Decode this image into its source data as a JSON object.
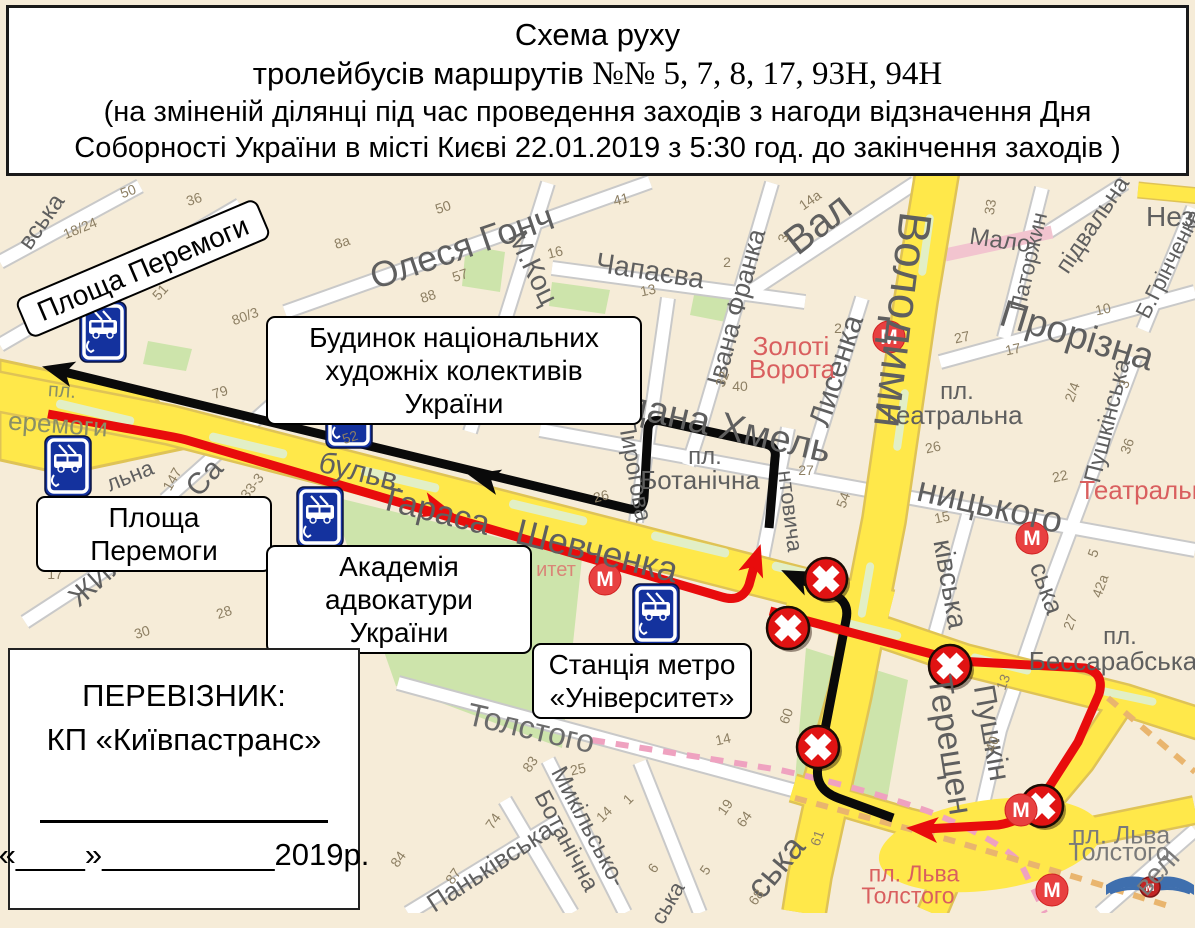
{
  "title": {
    "line1": "Схема руху",
    "line2_sans": "тролейбусів маршрутів ",
    "line2_serif": "№№ 5, 7, 8, 17, 93Н, 94Н",
    "line3": "(на зміненій ділянці під час проведення заходів з нагоди відзначення  Дня",
    "line4": "Соборності України в місті Києві 22.01.2019 з 5:30 год. до закінчення заходів )"
  },
  "carrier": {
    "label": "ПЕРЕВІЗНИК:",
    "name": "КП «Київпастранс»",
    "date_line": "«____»__________2019р."
  },
  "callouts": {
    "peremohy_rotated": "Площа Перемоги",
    "budynok_l1": "Будинок національних",
    "budynok_l2": "художніх колективів України",
    "peremohy": "Площа Перемоги",
    "akademia_l1": "Академія",
    "akademia_l2": "адвокатури України",
    "metro_l1": "Станція метро",
    "metro_l2": "«Університет»"
  },
  "colors": {
    "route_black": "#0a0a0a",
    "route_red": "#e80c0c",
    "road_yellow": "#ffe84a",
    "road_casing": "#dfc356",
    "park_green": "#cde4ab",
    "median_green": "#e2efc6",
    "closed_sign_red": "#e01313",
    "stop_sign_blue": "#14329e",
    "metro_red": "#e84040",
    "pink_street": "#f2c4cf",
    "metro_line_pink": "#efa2c0",
    "metro_line_tan": "#e9b56e"
  },
  "map": {
    "street_labels": [
      {
        "t": "вська",
        "x": 42,
        "y": 222,
        "r": -55,
        "s": 24
      },
      {
        "t": "льна",
        "x": 130,
        "y": 476,
        "r": -22,
        "s": 22
      },
      {
        "t": "Са",
        "x": 205,
        "y": 478,
        "r": -48,
        "s": 30
      },
      {
        "t": "ЖИЛЯН",
        "x": 112,
        "y": 566,
        "r": -42,
        "s": 28
      },
      {
        "t": "пл.",
        "x": 62,
        "y": 391,
        "r": 4,
        "s": 20,
        "c": "#8a8f66"
      },
      {
        "t": "еремоги",
        "x": 58,
        "y": 424,
        "r": 4,
        "s": 26,
        "c": "#8a8f66"
      },
      {
        "t": "бульв.",
        "x": 362,
        "y": 473,
        "r": 14,
        "s": 30
      },
      {
        "t": "Тараса",
        "x": 435,
        "y": 511,
        "r": 14,
        "s": 34
      },
      {
        "t": "Шевченка",
        "x": 597,
        "y": 551,
        "r": 14,
        "s": 36
      },
      {
        "t": "Олеся Гонч",
        "x": 462,
        "y": 247,
        "r": -19,
        "s": 36
      },
      {
        "t": "М.Коц",
        "x": 533,
        "y": 268,
        "r": 64,
        "s": 28
      },
      {
        "t": "Чапаєва",
        "x": 650,
        "y": 271,
        "r": 9,
        "s": 28
      },
      {
        "t": "Івана Франка",
        "x": 736,
        "y": 307,
        "r": -75,
        "s": 26
      },
      {
        "t": "Вал",
        "x": 818,
        "y": 224,
        "r": -38,
        "s": 40
      },
      {
        "t": "Лисенка",
        "x": 837,
        "y": 371,
        "r": -72,
        "s": 30
      },
      {
        "t": "Золоті",
        "x": 791,
        "y": 346,
        "r": 0,
        "s": 26,
        "c": "#d95f5f"
      },
      {
        "t": "Ворота",
        "x": 792,
        "y": 369,
        "r": 0,
        "s": 26,
        "c": "#d95f5f"
      },
      {
        "t": "Володими",
        "x": 903,
        "y": 320,
        "r": 97,
        "s": 46
      },
      {
        "t": "Богдана Хмель",
        "x": 700,
        "y": 421,
        "r": 13,
        "s": 38
      },
      {
        "t": "ницького",
        "x": 990,
        "y": 505,
        "r": 13,
        "s": 36
      },
      {
        "t": "пл.",
        "x": 705,
        "y": 457,
        "r": 0,
        "s": 24
      },
      {
        "t": "Ботанічна",
        "x": 700,
        "y": 480,
        "r": 0,
        "s": 26
      },
      {
        "t": "Пирогова",
        "x": 634,
        "y": 470,
        "r": 80,
        "s": 24
      },
      {
        "t": "нтовича",
        "x": 790,
        "y": 511,
        "r": 83,
        "s": 22
      },
      {
        "t": "пл.",
        "x": 957,
        "y": 392,
        "r": 0,
        "s": 24
      },
      {
        "t": "Театральна",
        "x": 952,
        "y": 415,
        "r": 0,
        "s": 26
      },
      {
        "t": "Прорізна",
        "x": 1077,
        "y": 336,
        "r": 17,
        "s": 38
      },
      {
        "t": "Мало",
        "x": 1000,
        "y": 241,
        "r": 8,
        "s": 24
      },
      {
        "t": "підвальна",
        "x": 1093,
        "y": 225,
        "r": -56,
        "s": 24
      },
      {
        "t": "Паторжин",
        "x": 1029,
        "y": 262,
        "r": -77,
        "s": 22
      },
      {
        "t": "Б.Грінченка",
        "x": 1169,
        "y": 264,
        "r": -63,
        "s": 22
      },
      {
        "t": "Нез",
        "x": 1170,
        "y": 217,
        "r": 0,
        "s": 28
      },
      {
        "t": "Театральна",
        "x": 1150,
        "y": 490,
        "r": 0,
        "s": 26,
        "c": "#d95f5f"
      },
      {
        "t": "ківська",
        "x": 950,
        "y": 584,
        "r": 80,
        "s": 28
      },
      {
        "t": "ська",
        "x": 1047,
        "y": 588,
        "r": 70,
        "s": 26
      },
      {
        "t": "Пушкінська",
        "x": 1108,
        "y": 421,
        "r": -76,
        "s": 24
      },
      {
        "t": "Пушкін",
        "x": 991,
        "y": 733,
        "r": 80,
        "s": 30
      },
      {
        "t": "Терещен",
        "x": 950,
        "y": 745,
        "r": 81,
        "s": 34
      },
      {
        "t": "пл.",
        "x": 1120,
        "y": 637,
        "r": 0,
        "s": 24
      },
      {
        "t": "Бессарабська",
        "x": 1113,
        "y": 661,
        "r": 0,
        "s": 26
      },
      {
        "t": "Толстого",
        "x": 531,
        "y": 728,
        "r": 13,
        "s": 32,
        "c": "#6b6b6b"
      },
      {
        "t": "Микільсько-",
        "x": 588,
        "y": 827,
        "r": 62,
        "s": 24
      },
      {
        "t": "Ботанічна",
        "x": 566,
        "y": 841,
        "r": 62,
        "s": 24
      },
      {
        "t": "Паньківська",
        "x": 490,
        "y": 866,
        "r": -33,
        "s": 26
      },
      {
        "t": "ська",
        "x": 776,
        "y": 867,
        "r": -50,
        "s": 34
      },
      {
        "t": "ська",
        "x": 668,
        "y": 903,
        "r": -60,
        "s": 22
      },
      {
        "t": "пл. Льва",
        "x": 914,
        "y": 874,
        "r": 0,
        "s": 23,
        "c": "#d95f5f"
      },
      {
        "t": "Толстого",
        "x": 908,
        "y": 896,
        "r": 0,
        "s": 23,
        "c": "#d95f5f"
      },
      {
        "t": "пл. Льва",
        "x": 1121,
        "y": 836,
        "r": 0,
        "s": 25,
        "c": "#7a7a7a"
      },
      {
        "t": "Толстого",
        "x": 1119,
        "y": 853,
        "r": 0,
        "s": 25,
        "c": "#7a7a7a"
      },
      {
        "t": "велі",
        "x": 1157,
        "y": 872,
        "r": -48,
        "s": 28,
        "c": "#7a7a7a"
      },
      {
        "t": "итет",
        "x": 556,
        "y": 570,
        "r": 0,
        "s": 20,
        "c": "#d98577"
      },
      {
        "t": "ров.",
        "x": 382,
        "y": 404,
        "r": 0,
        "s": 15
      }
    ],
    "house_numbers": [
      {
        "t": "18/24",
        "x": 80,
        "y": 228,
        "r": -22
      },
      {
        "t": "50",
        "x": 128,
        "y": 191,
        "r": -20
      },
      {
        "t": "36",
        "x": 194,
        "y": 199,
        "r": -18
      },
      {
        "t": "39",
        "x": 252,
        "y": 217,
        "r": -18
      },
      {
        "t": "51",
        "x": 160,
        "y": 292,
        "r": -48
      },
      {
        "t": "80/3",
        "x": 245,
        "y": 316,
        "r": -20
      },
      {
        "t": "8а",
        "x": 342,
        "y": 242,
        "r": -18
      },
      {
        "t": "50",
        "x": 443,
        "y": 207,
        "r": -18
      },
      {
        "t": "88",
        "x": 428,
        "y": 296,
        "r": -18
      },
      {
        "t": "57",
        "x": 460,
        "y": 275,
        "r": -18
      },
      {
        "t": "16",
        "x": 555,
        "y": 252,
        "r": -14
      },
      {
        "t": "41",
        "x": 621,
        "y": 199,
        "r": -14
      },
      {
        "t": "13",
        "x": 648,
        "y": 290,
        "r": -12
      },
      {
        "t": "79",
        "x": 220,
        "y": 392,
        "r": -18
      },
      {
        "t": "52",
        "x": 350,
        "y": 437,
        "r": -18
      },
      {
        "t": "33-3",
        "x": 252,
        "y": 486,
        "r": -52
      },
      {
        "t": "147",
        "x": 172,
        "y": 479,
        "r": -60
      },
      {
        "t": "17",
        "x": 55,
        "y": 574,
        "r": 0
      },
      {
        "t": "28",
        "x": 224,
        "y": 612,
        "r": -18
      },
      {
        "t": "30",
        "x": 142,
        "y": 632,
        "r": -18
      },
      {
        "t": "106",
        "x": 337,
        "y": 617,
        "r": -70
      },
      {
        "t": "37",
        "x": 568,
        "y": 407,
        "r": -14
      },
      {
        "t": "26",
        "x": 601,
        "y": 496,
        "r": -14
      },
      {
        "t": "40",
        "x": 740,
        "y": 386,
        "r": 0
      },
      {
        "t": "32",
        "x": 722,
        "y": 379,
        "r": -70
      },
      {
        "t": "27",
        "x": 806,
        "y": 470,
        "r": 0
      },
      {
        "t": "2",
        "x": 838,
        "y": 328,
        "r": 0
      },
      {
        "t": "14а",
        "x": 810,
        "y": 200,
        "r": -35
      },
      {
        "t": "3",
        "x": 783,
        "y": 238,
        "r": -70
      },
      {
        "t": "2",
        "x": 727,
        "y": 262,
        "r": 0
      },
      {
        "t": "33",
        "x": 990,
        "y": 207,
        "r": -80
      },
      {
        "t": "27",
        "x": 962,
        "y": 337,
        "r": -12
      },
      {
        "t": "17",
        "x": 1013,
        "y": 349,
        "r": -12
      },
      {
        "t": "10",
        "x": 1103,
        "y": 309,
        "r": -12
      },
      {
        "t": "2/4",
        "x": 1072,
        "y": 392,
        "r": -70
      },
      {
        "t": "3",
        "x": 1124,
        "y": 384,
        "r": -70
      },
      {
        "t": "36",
        "x": 1127,
        "y": 446,
        "r": -70
      },
      {
        "t": "26",
        "x": 933,
        "y": 447,
        "r": -12
      },
      {
        "t": "22",
        "x": 1060,
        "y": 476,
        "r": -12
      },
      {
        "t": "15",
        "x": 942,
        "y": 517,
        "r": -12
      },
      {
        "t": "54",
        "x": 843,
        "y": 500,
        "r": -70
      },
      {
        "t": "5",
        "x": 1093,
        "y": 553,
        "r": -70
      },
      {
        "t": "42а",
        "x": 1100,
        "y": 586,
        "r": -70
      },
      {
        "t": "27",
        "x": 1070,
        "y": 622,
        "r": -70
      },
      {
        "t": "13",
        "x": 1003,
        "y": 682,
        "r": -70
      },
      {
        "t": "40",
        "x": 992,
        "y": 744,
        "r": -70
      },
      {
        "t": "60",
        "x": 786,
        "y": 716,
        "r": -70
      },
      {
        "t": "14",
        "x": 723,
        "y": 739,
        "r": -12
      },
      {
        "t": "61",
        "x": 817,
        "y": 838,
        "r": -70
      },
      {
        "t": "19",
        "x": 725,
        "y": 807,
        "r": -55
      },
      {
        "t": "64",
        "x": 744,
        "y": 819,
        "r": -55
      },
      {
        "t": "68",
        "x": 756,
        "y": 897,
        "r": -55
      },
      {
        "t": "5",
        "x": 705,
        "y": 870,
        "r": -55
      },
      {
        "t": "6",
        "x": 653,
        "y": 868,
        "r": -55
      },
      {
        "t": "25",
        "x": 578,
        "y": 769,
        "r": -12
      },
      {
        "t": "83",
        "x": 530,
        "y": 764,
        "r": -55
      },
      {
        "t": "74",
        "x": 493,
        "y": 821,
        "r": -55
      },
      {
        "t": "84",
        "x": 398,
        "y": 859,
        "r": -55
      },
      {
        "t": "87",
        "x": 453,
        "y": 876,
        "r": -55
      },
      {
        "t": "14",
        "x": 604,
        "y": 814,
        "r": -45
      },
      {
        "t": "1",
        "x": 628,
        "y": 799,
        "r": -45
      }
    ],
    "closed_signs": [
      {
        "x": 826,
        "y": 579
      },
      {
        "x": 788,
        "y": 628
      },
      {
        "x": 950,
        "y": 666
      },
      {
        "x": 818,
        "y": 747
      },
      {
        "x": 1042,
        "y": 806
      }
    ],
    "trolleybus_stops": [
      {
        "x": 103,
        "y": 332
      },
      {
        "x": 68,
        "y": 466
      },
      {
        "x": 349,
        "y": 418
      },
      {
        "x": 320,
        "y": 517
      },
      {
        "x": 656,
        "y": 614
      }
    ],
    "metro_stations": [
      {
        "x": 605,
        "y": 579
      },
      {
        "x": 889,
        "y": 337
      },
      {
        "x": 1032,
        "y": 538
      },
      {
        "x": 1021,
        "y": 810
      },
      {
        "x": 1052,
        "y": 890
      }
    ],
    "metro_letter": "М"
  }
}
